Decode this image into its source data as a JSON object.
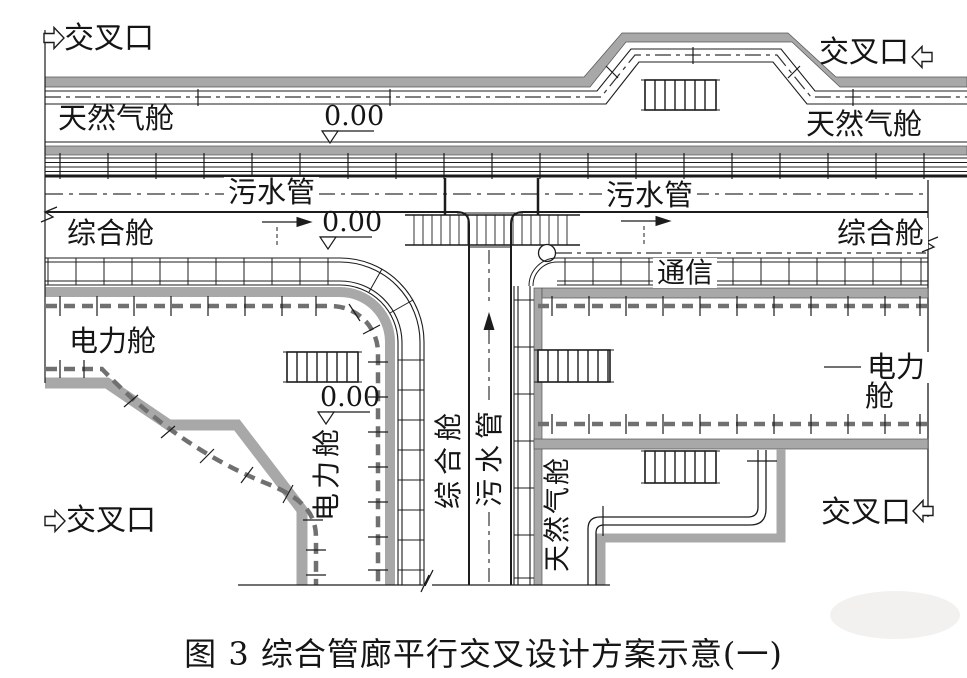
{
  "caption": "图 3  综合管廊平行交叉设计方案示意(一)",
  "labels": {
    "junction": "交叉口",
    "gas": "天然气舱",
    "sewage": "污水管",
    "utility": "综合舱",
    "comm": "通信",
    "power": "电力舱",
    "power_l1": "电力",
    "power_l2": "舱",
    "elevation": "0.00"
  },
  "colors": {
    "wall_gray": "#a8a8a8",
    "line_black": "#1c1c1c",
    "cable_gray": "#707070",
    "background": "#ffffff"
  }
}
